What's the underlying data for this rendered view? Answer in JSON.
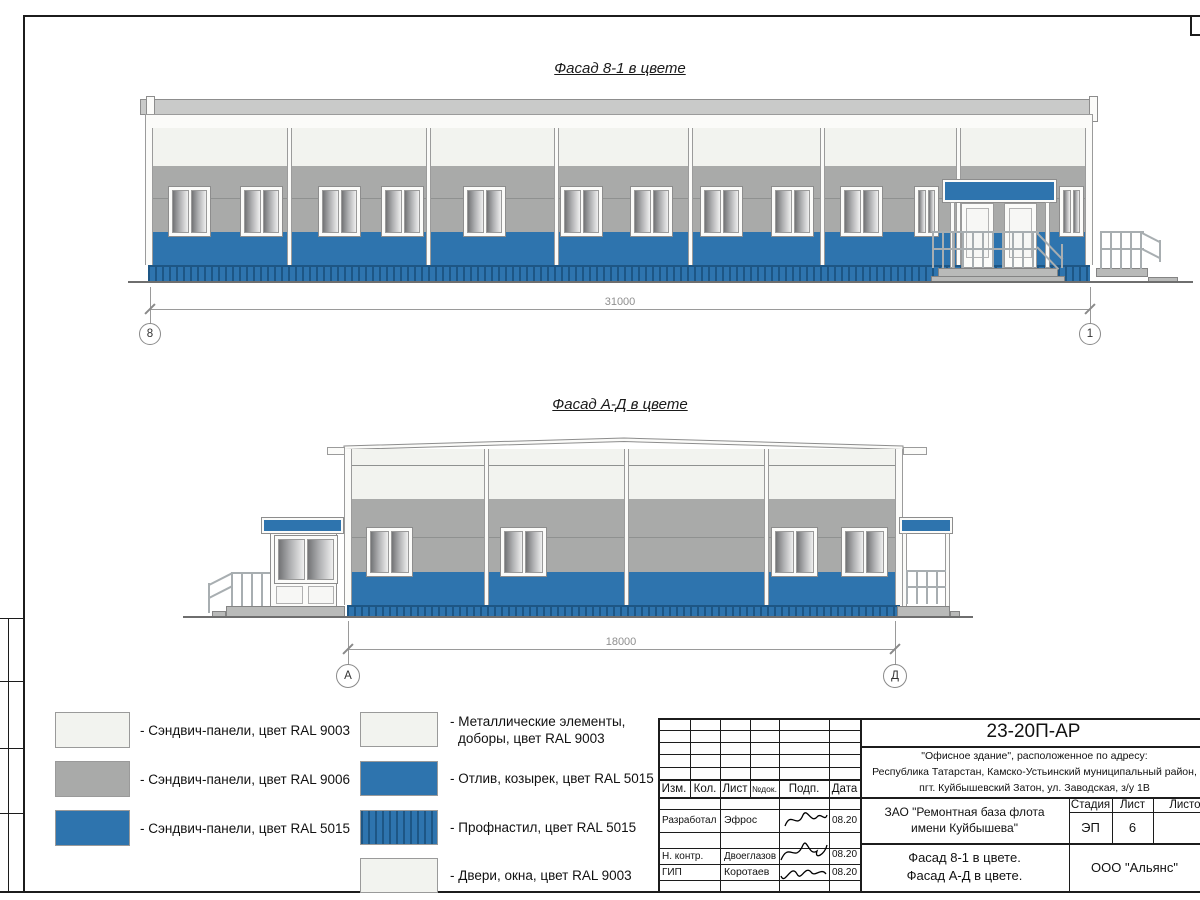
{
  "colors": {
    "blue": "#2e74ae",
    "blue_dark": "#1d5685",
    "gray": "#a9aaa9",
    "roof_gray": "#c9cac9",
    "white_panel": "#f2f3ef",
    "fascia": "#fbfbf9"
  },
  "facade1": {
    "title": "Фасад 8-1 в цвете",
    "dim": "31000",
    "axis_left": "8",
    "axis_right": "1"
  },
  "facade2": {
    "title": "Фасад А-Д в цвете",
    "dim": "18000",
    "axis_left": "А",
    "axis_right": "Д"
  },
  "legend": {
    "left": [
      {
        "label": "- Сэндвич-панели, цвет RAL 9003"
      },
      {
        "label": "- Сэндвич-панели, цвет RAL 9006"
      },
      {
        "label": "- Сэндвич-панели, цвет RAL 5015"
      }
    ],
    "right": [
      {
        "line1": "- Металлические элементы,",
        "line2": "доборы, цвет RAL 9003"
      },
      {
        "label": "- Отлив, козырек, цвет RAL 5015"
      },
      {
        "label": "- Профнастил, цвет RAL 5015"
      },
      {
        "label": "- Двери, окна, цвет RAL 9003"
      }
    ]
  },
  "titleblock": {
    "doc_number": "23-20П-АР",
    "address1": "\"Офисное здание\", расположенное по адресу:",
    "address2": "Республика Татарстан, Камско-Устьинский муниципальный район,",
    "address3": "пгт. Куйбышевский Затон, ул. Заводская, з/у 1В",
    "col_izm": "Изм.",
    "col_kol": "Кол.",
    "col_list": "Лист",
    "col_ndok": "№док.",
    "col_podp": "Подп.",
    "col_data": "Дата",
    "row1_role": "Разработал",
    "row1_name": "Эфрос",
    "row1_date": "08.20",
    "row2_role": "Н. контр.",
    "row2_name": "Двоеглазов",
    "row2_date": "08.20",
    "row3_role": "ГИП",
    "row3_name": "Коротаев",
    "row3_date": "08.20",
    "client1": "ЗАО \"Ремонтная база флота",
    "client2": "имени Куйбышева\"",
    "stage_label": "Стадия",
    "sheet_label": "Лист",
    "sheets_label": "Листов",
    "stage": "ЭП",
    "sheet_num": "6",
    "subject1": "Фасад 8-1 в цвете.",
    "subject2": "Фасад А-Д в цвете.",
    "org": "ООО \"Альянс\""
  }
}
